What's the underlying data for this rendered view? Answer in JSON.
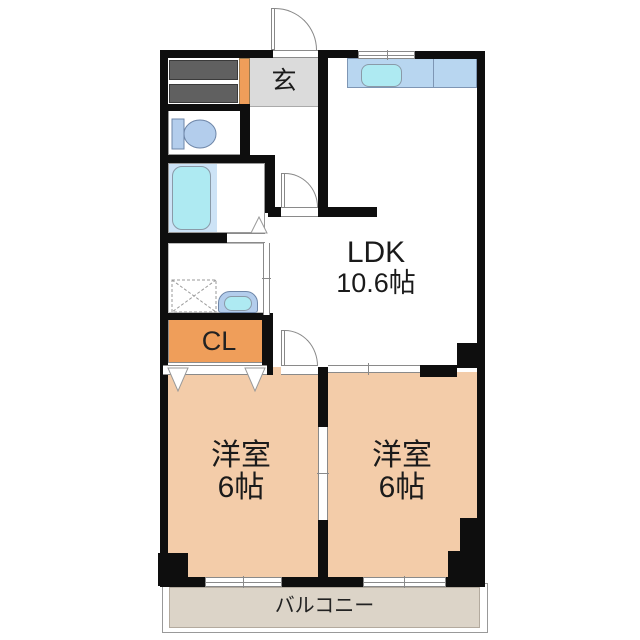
{
  "rooms": {
    "genkan": {
      "label": "玄"
    },
    "ldk": {
      "label": "LDK",
      "size": "10.6帖"
    },
    "bedroom_left": {
      "label": "洋室",
      "size": "6帖"
    },
    "bedroom_right": {
      "label": "洋室",
      "size": "6帖"
    },
    "closet": {
      "label": "CL"
    },
    "balcony": {
      "label": "バルコニー"
    }
  },
  "colors": {
    "wall": "#0e0e0e",
    "room_floor": "#f3cca9",
    "accent_orange": "#ef9e5a",
    "genkan_gray": "#dbdbdb",
    "storage_gray": "#606060",
    "kitchen_counter": "#b8d6f0",
    "bath_floor": "#cde3f6",
    "water_cyan": "#aeeaf2",
    "fixture_blue": "#b3cdec",
    "balcony_floor": "#dcd4c8"
  }
}
